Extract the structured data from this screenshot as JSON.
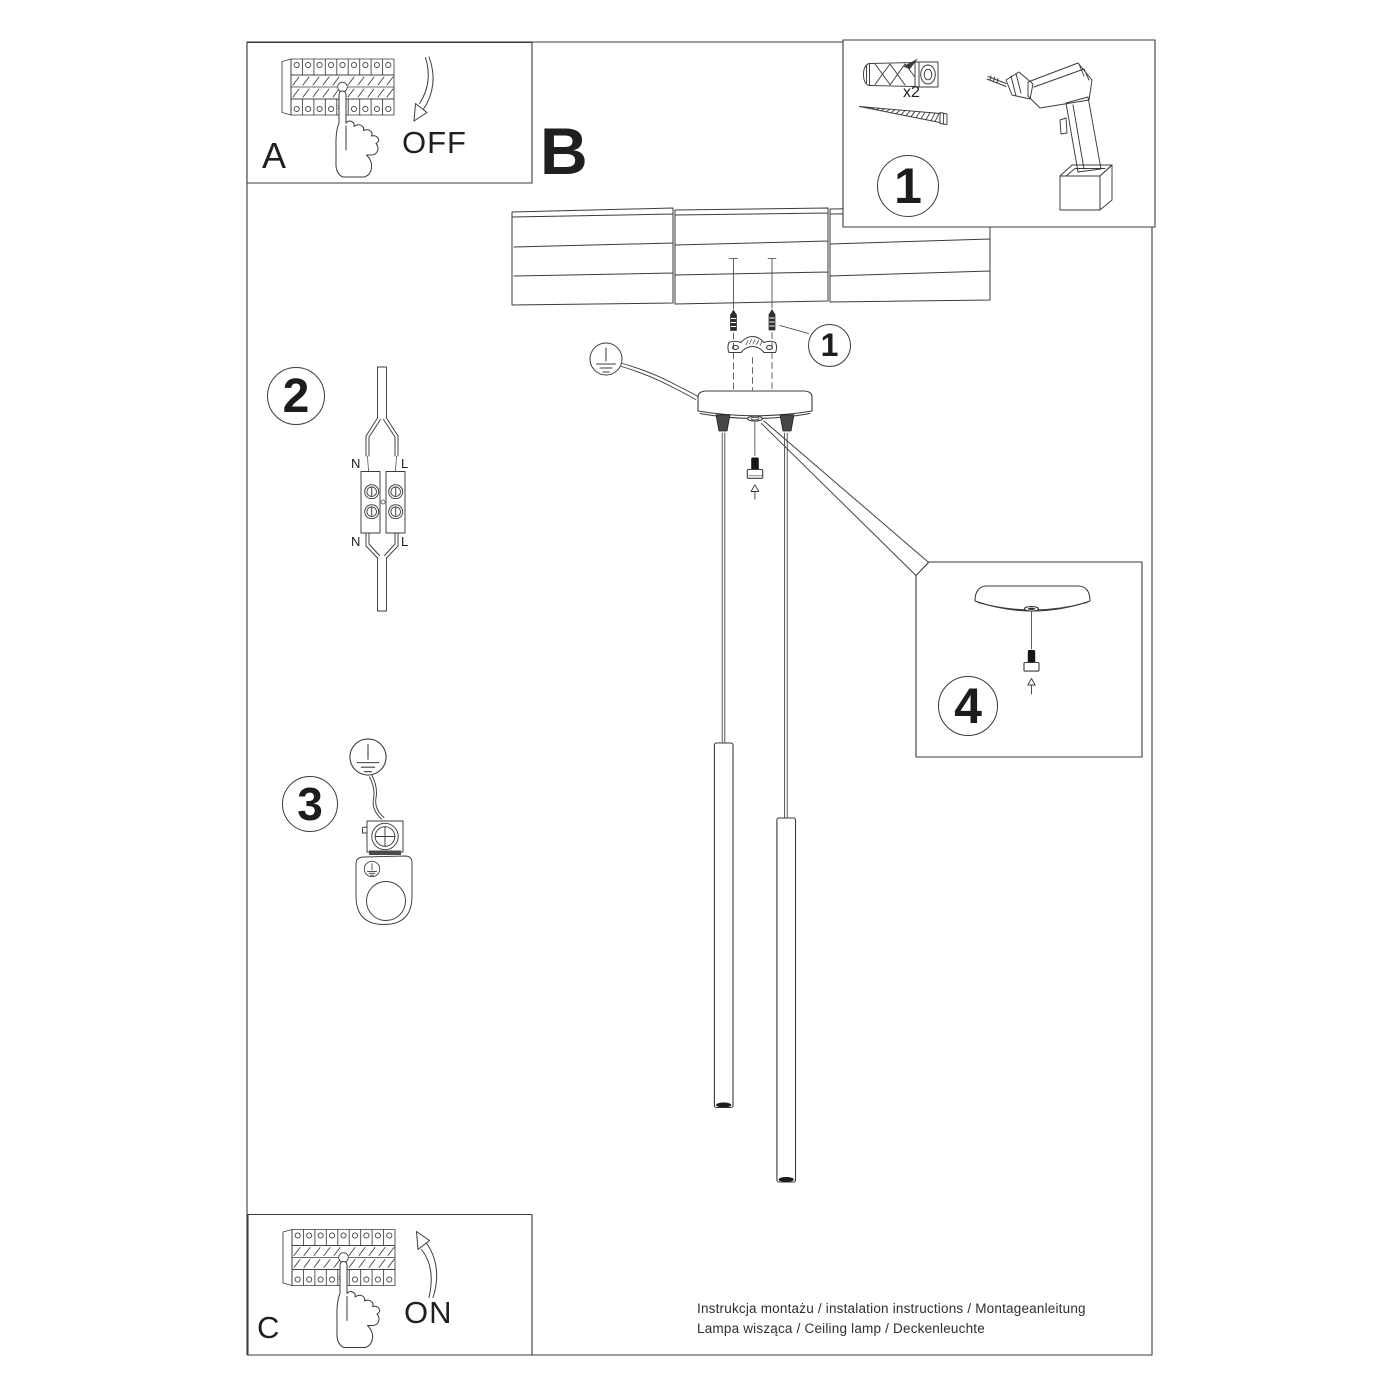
{
  "colors": {
    "background": "#ffffff",
    "line": "#3b3b3b",
    "text": "#1f1f1f"
  },
  "panel_a": {
    "label": "A",
    "state": "OFF"
  },
  "panel_b": {
    "label": "B"
  },
  "panel_c": {
    "label": "C",
    "state": "ON"
  },
  "parts_box": {
    "number": "1",
    "screw_quantity": "x2"
  },
  "step_callouts": {
    "screws": "1",
    "wiring": "2",
    "grounding": "3",
    "canopy_detail": "4"
  },
  "wiring_diagram": {
    "top_left": "N",
    "top_right": "L",
    "bottom_left": "N",
    "bottom_right": "L"
  },
  "footer": {
    "line1": "Instrukcja montażu / instalation instructions / Montageanleitung",
    "line2": "Lampa wisząca / Ceiling lamp / Deckenleuchte"
  }
}
